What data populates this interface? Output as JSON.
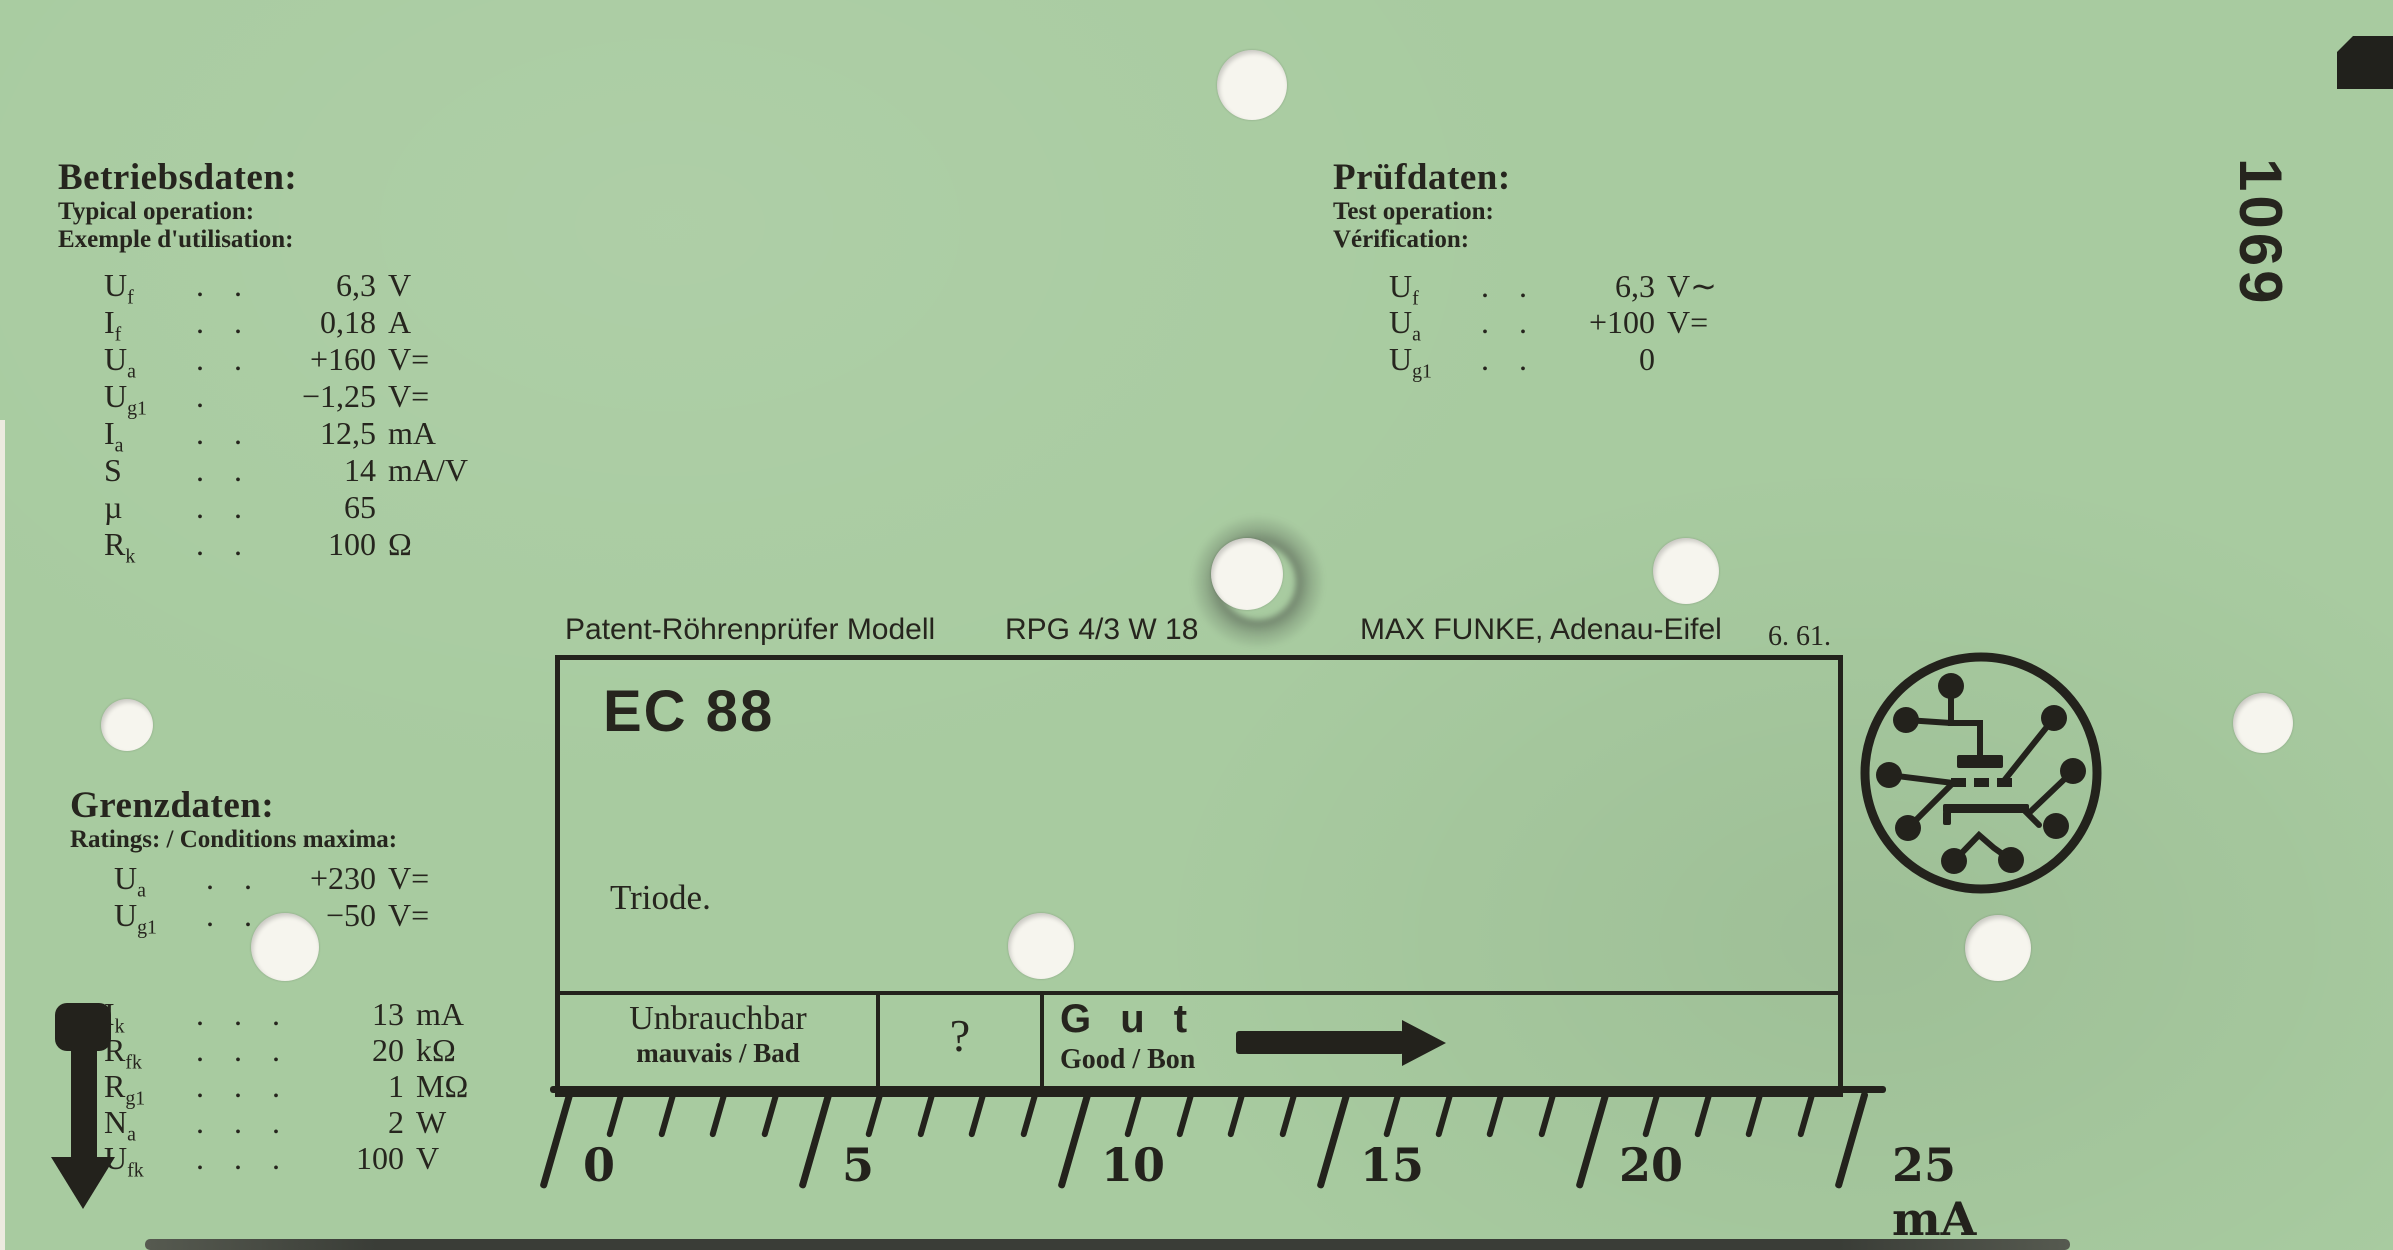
{
  "colors": {
    "card": "#a8cba0",
    "ink": "#23221c",
    "hole": "#f6f5ee"
  },
  "serial": "1069",
  "blocks": {
    "betriebsdaten": {
      "title": "Betriebsdaten:",
      "sub1": "Typical operation:",
      "sub2": "Exemple d'utilisation:",
      "rows": [
        {
          "s": "U",
          "sub": "f",
          "d": ". . . .",
          "v": "6,3",
          "u": "V"
        },
        {
          "s": "I",
          "sub": "f",
          "d": ". . . .",
          "v": "0,18",
          "u": "A"
        },
        {
          "s": "U",
          "sub": "a",
          "d": ". . .",
          "v": "+160",
          "u": "V="
        },
        {
          "s": "U",
          "sub": "g1",
          "d": ".",
          "v": "−1,25",
          "u": "V="
        },
        {
          "s": "I",
          "sub": "a",
          "d": ". . . .",
          "v": "12,5",
          "u": "mA"
        },
        {
          "s": "S",
          "sub": "",
          "d": ". .",
          "v": "14",
          "u": "mA/V"
        },
        {
          "s": "µ",
          "sub": "",
          "d": ". . . . .",
          "v": "65",
          "u": ""
        },
        {
          "s": "R",
          "sub": "k",
          "d": ". . . .",
          "v": "100",
          "u": "Ω"
        }
      ]
    },
    "pruefdaten": {
      "title": "Prüfdaten:",
      "sub1": "Test operation:",
      "sub2": "Vérification:",
      "rows": [
        {
          "s": "U",
          "sub": "f",
          "d": ". . . .",
          "v": "6,3",
          "u": "V∼"
        },
        {
          "s": "U",
          "sub": "a",
          "d": ". . .",
          "v": "+100",
          "u": "V="
        },
        {
          "s": "U",
          "sub": "g1",
          "d": ". . . .",
          "v": "0",
          "u": ""
        }
      ]
    },
    "grenzdaten": {
      "title": "Grenzdaten:",
      "sub1": "Ratings: / Conditions maxima:",
      "rows": [
        {
          "s": "U",
          "sub": "a",
          "d": ". . .",
          "v": "+230",
          "u": "V="
        },
        {
          "s": "U",
          "sub": "g1",
          "d": ". . .",
          "v": "−50",
          "u": "V="
        }
      ]
    },
    "limits": {
      "rows": [
        {
          "s": "I",
          "sub": "k",
          "d": ". . . . .",
          "v": "13",
          "u": "mA"
        },
        {
          "s": "R",
          "sub": "fk",
          "d": ". . . .",
          "v": "20",
          "u": "kΩ"
        },
        {
          "s": "R",
          "sub": "g1",
          "d": ". . . . .",
          "v": "1",
          "u": "MΩ"
        },
        {
          "s": "N",
          "sub": "a",
          "d": ". . . . .",
          "v": "2",
          "u": "W"
        },
        {
          "s": "U",
          "sub": "fk",
          "d": ". . . .",
          "v": "100",
          "u": "V"
        }
      ]
    }
  },
  "header_line": {
    "left": "Patent-Röhrenprüfer Modell",
    "model": "RPG 4/3 W 18",
    "maker": "MAX FUNKE, Adenau-Eifel",
    "date": "6. 61."
  },
  "tube": {
    "name": "EC 88",
    "type": "Triode."
  },
  "verdict": {
    "bad_title": "Unbrauchbar",
    "bad_sub": "mauvais / Bad",
    "question": "?",
    "good_title": "G u t",
    "good_sub": "Good / Bon"
  },
  "scale": {
    "min": 0,
    "max": 25,
    "major_step": 5,
    "major_labels": [
      "0",
      "5",
      "10",
      "15",
      "20"
    ],
    "end_label": "25 mA",
    "unit": "mA"
  }
}
